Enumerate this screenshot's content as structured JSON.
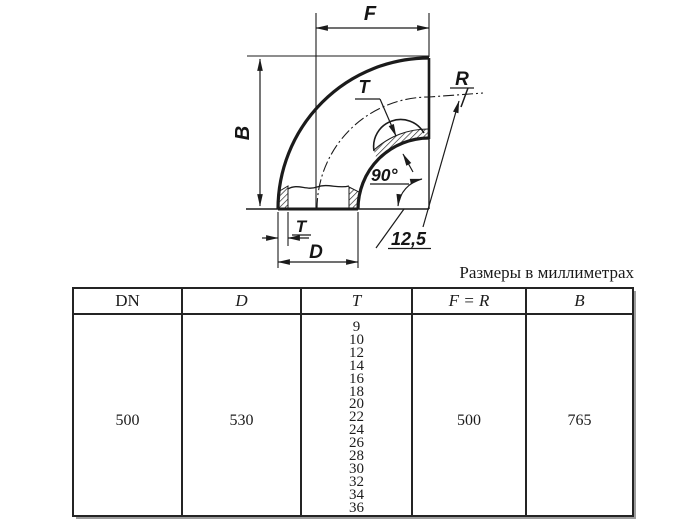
{
  "note": "Размеры в миллиметрах",
  "diagram": {
    "labels": {
      "F": "F",
      "B": "B",
      "D": "D",
      "T_bottom": "T",
      "T_top": "T",
      "R": "R",
      "angle": "90°",
      "roughness": "12,5"
    }
  },
  "table": {
    "headers": [
      "DN",
      "D",
      "T",
      "F = R",
      "B"
    ],
    "row": {
      "dn": "500",
      "d": "530",
      "t_values": [
        "9",
        "10",
        "12",
        "14",
        "16",
        "18",
        "20",
        "22",
        "24",
        "26",
        "28",
        "30",
        "32",
        "34",
        "36"
      ],
      "f_r": "500",
      "b": "765"
    }
  },
  "colors": {
    "line": "#1b1b1b",
    "background": "#ffffff"
  }
}
